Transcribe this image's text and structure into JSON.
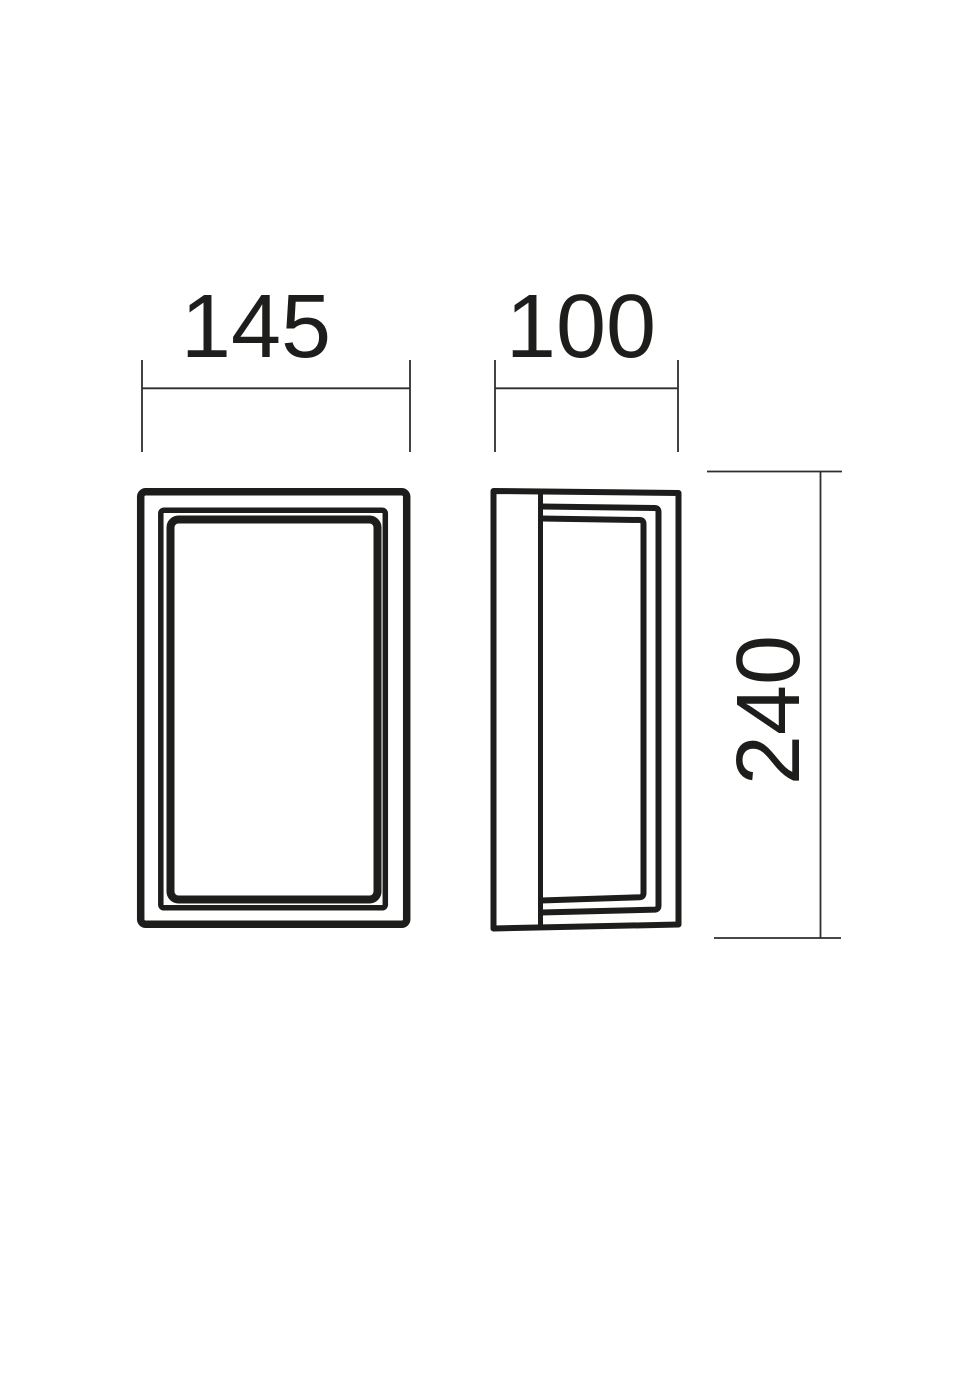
{
  "dimensions": {
    "front_width": {
      "value": "145"
    },
    "side_depth": {
      "value": "100"
    },
    "height": {
      "value": "240"
    }
  },
  "colors": {
    "background": "#ffffff",
    "object_line": "#1d1d1b",
    "dimension_line": "#2e2e2c",
    "text": "#1d1d1b"
  }
}
